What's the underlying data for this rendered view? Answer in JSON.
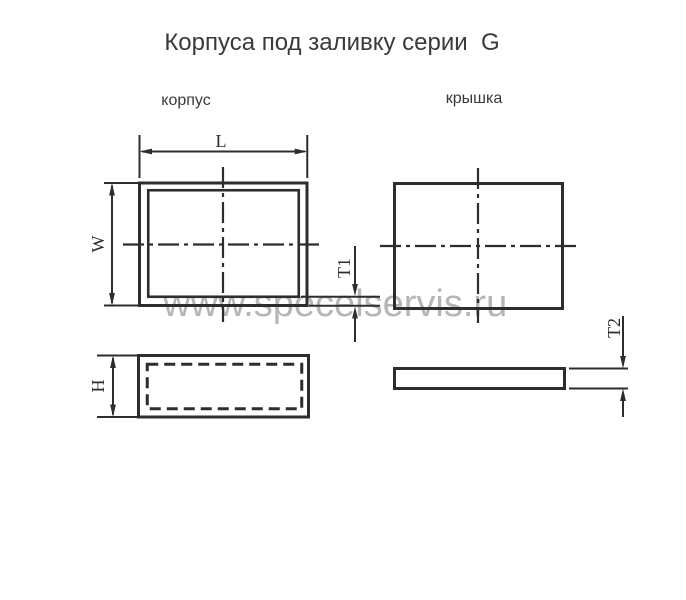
{
  "title": "Корпуса под заливку серии  G",
  "views": {
    "body": {
      "label": "корпус"
    },
    "lid": {
      "label": "крышка"
    }
  },
  "dimensions": {
    "length": "L",
    "width": "W",
    "height": "H",
    "bottom_thickness": "T1",
    "lid_thickness": "T2"
  },
  "watermark": "www.specelservis.ru",
  "colors": {
    "line": "#2d2d2d",
    "text": "#3a3a3a",
    "watermark": "#b6b6b6",
    "background": "#ffffff"
  }
}
